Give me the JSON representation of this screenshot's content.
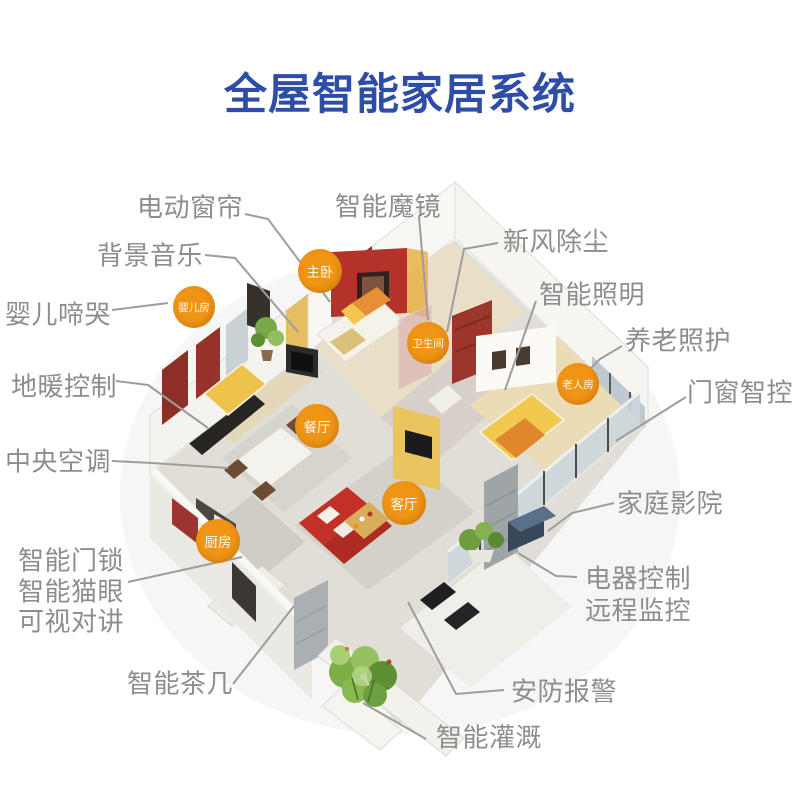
{
  "title": "全屋智能家居系统",
  "colors": {
    "title_blue": "#2e4da6",
    "label_gray": "#8d8d8d",
    "leader_line_gray": "#9d9d9d",
    "badge_orange": "#ef9415",
    "accent_red_wall": "#b43229",
    "accent_yellow_wall": "#eac45e"
  },
  "feature_labels": {
    "electric_curtain": "电动窗帘",
    "smart_mirror": "智能魔镜",
    "background_music": "背景音乐",
    "fresh_air": "新风除尘",
    "baby_cry": "婴儿啼哭",
    "smart_lighting": "智能照明",
    "elder_care": "养老照护",
    "floor_heating": "地暖控制",
    "door_window": "门窗智控",
    "central_ac": "中央空调",
    "home_theater": "家庭影院",
    "smart_lock": "智能门锁",
    "smart_peephole": "智能猫眼",
    "video_intercom": "可视对讲",
    "appliance_control": "电器控制",
    "remote_monitor": "远程监控",
    "smart_tea_table": "智能茶几",
    "security_alarm": "安防报警",
    "smart_irrigation": "智能灌溉"
  },
  "room_badges": {
    "master_bedroom": "主卧",
    "nursery": "婴儿房",
    "bathroom": "卫生间",
    "dining_room": "餐厅",
    "elder_room": "老人房",
    "living_room": "客厅",
    "kitchen": "厨房"
  }
}
